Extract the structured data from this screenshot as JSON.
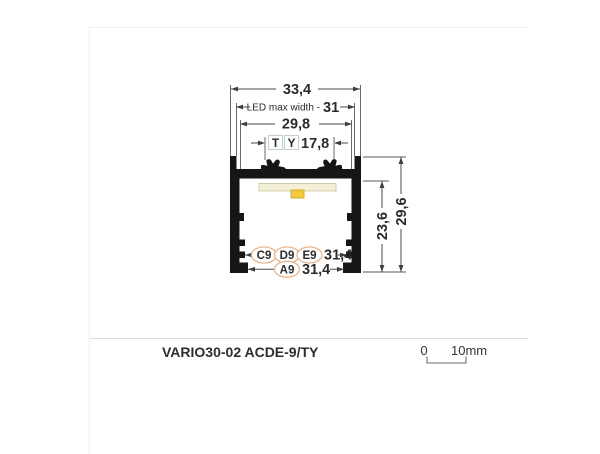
{
  "product": {
    "name": "VARIO30-02 ACDE-9/TY"
  },
  "scalebar": {
    "zero": "0",
    "ten_mm": "10mm"
  },
  "dimensions": {
    "total_width": "33,4",
    "led_max_width_label": "LED max width -",
    "led_max_width_value": "31",
    "opening_width": "29,8",
    "clip_spacing": "17,8",
    "inner_height": "23,6",
    "total_height": "29,6",
    "groove_width_cde": "31,4",
    "groove_width_a": "31,4"
  },
  "variant_tags": {
    "t": "T",
    "y": "Y",
    "c9": "C9",
    "d9": "D9",
    "e9": "E9",
    "a9": "A9"
  },
  "colors": {
    "profile_black": "#161616",
    "dimension_line": "#4a4a4a",
    "tag_t_teal": "#1d8a72",
    "tag_y_green": "#74c29c",
    "tag_box_border": "#c3d1c9",
    "variant_orange": "#c8671f",
    "variant_oval_border": "#eab58b",
    "pcb_strip_cream": "#f4efd7",
    "led_chip_yellow": "#f3cb3a",
    "footer_text": "#3c3c3c",
    "divider_gray": "#dcdcdc"
  }
}
